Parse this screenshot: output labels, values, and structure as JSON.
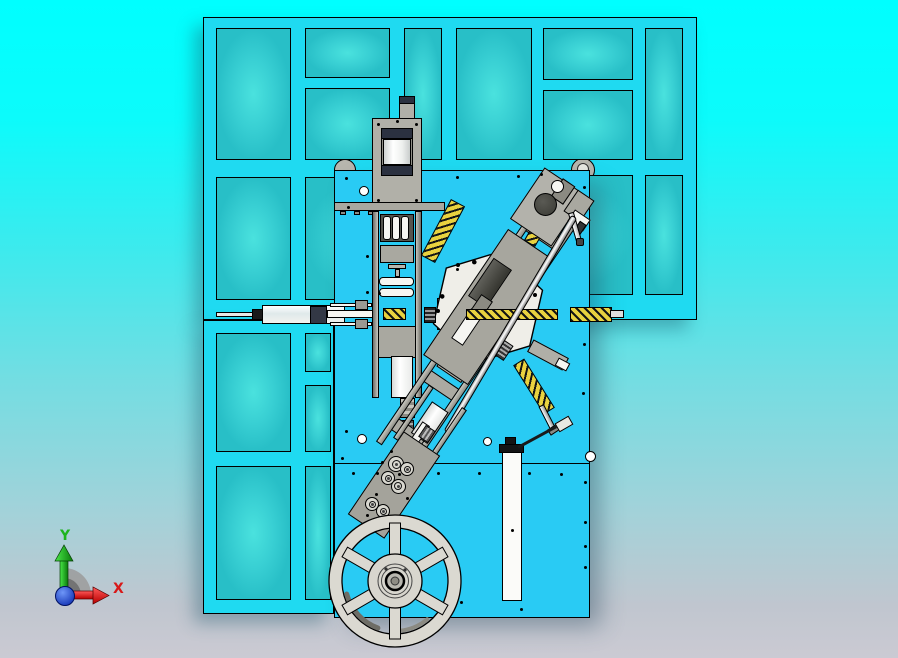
{
  "viewport": {
    "description": "CAD top view of a wire-forming machine assembly on a framed base",
    "view_name": "top-view",
    "axis_labels": {
      "x": "X",
      "y": "Y"
    }
  },
  "parts": {
    "frame": "machine-frame",
    "plate": "base-plate",
    "tower": "vertical-press-unit",
    "h_cylinder": "horizontal-pneumatic-cylinder",
    "diagonal": "inclined-feed-unit",
    "hexagon": "hex-mounting-plate",
    "rollers": "wire-straightener-rollers",
    "wheel": "wire-spool-wheel",
    "rail": "linear-guide-rail"
  },
  "colors": {
    "background_top": "#00ffff",
    "background_bottom": "#cbcad3",
    "frame_beam": "#1fdaf1",
    "frame_panel": "#38cfd3",
    "plate": "#29cbf4",
    "machinery_gray": "#b1b0a8",
    "machinery_white": "#f6f6f2",
    "spring_yellow": "#e9d23f",
    "wheel_gray": "#dbd9d1",
    "axis_x": "#d81818",
    "axis_y": "#1db41d",
    "origin_blue": "#1038c8",
    "outline": "#000000"
  }
}
